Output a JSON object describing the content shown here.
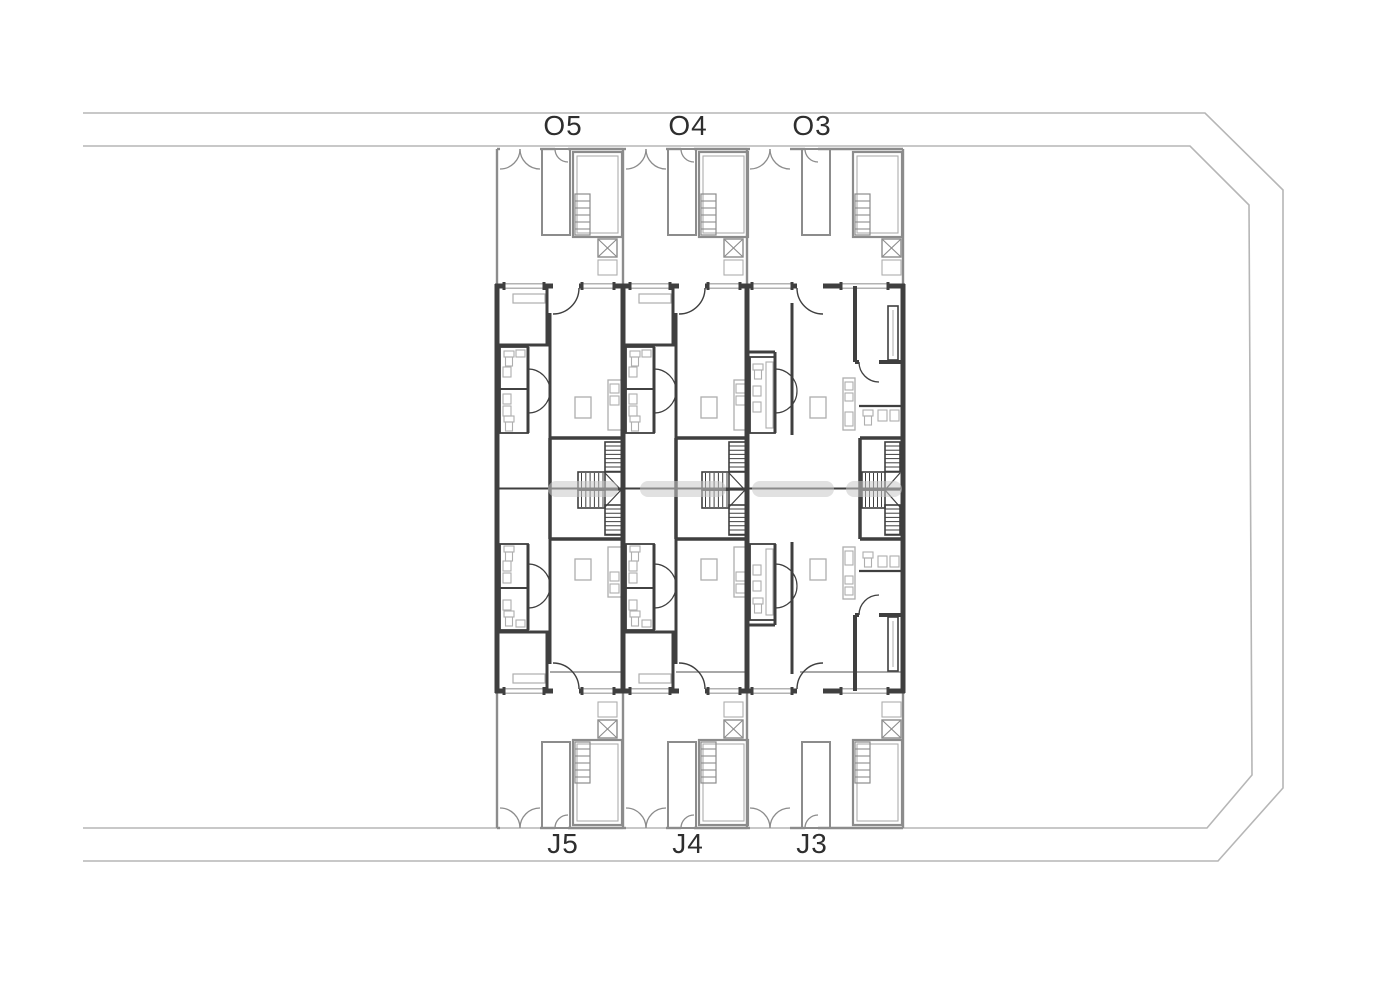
{
  "canvas": {
    "width": 1400,
    "height": 989,
    "background": "#ffffff"
  },
  "colors": {
    "site_line": "#b6b6b6",
    "yard_line": "#8c8c8c",
    "wall": "#3f3f3f",
    "fixture": "#aeaeae",
    "window": "#9a9a9a",
    "label": "#2e2e2e",
    "watermark": "#c8c8c8"
  },
  "site": {
    "outer_boundary": [
      [
        83,
        113
      ],
      [
        1205,
        113
      ],
      [
        1283,
        190
      ],
      [
        1283,
        788
      ],
      [
        1218,
        861
      ],
      [
        83,
        861
      ]
    ],
    "inner_boundary": [
      [
        83,
        146
      ],
      [
        1190,
        146
      ],
      [
        1249,
        205
      ],
      [
        1252,
        775
      ],
      [
        1207,
        828
      ],
      [
        83,
        828
      ]
    ]
  },
  "building": {
    "left": 497,
    "right": 903,
    "party_walls": [
      623,
      747
    ],
    "yard_top_wall": 149,
    "facade_top": 286,
    "facade_bottom": 691,
    "yard_bottom_wall": 828,
    "mirror_axis": 488.5
  },
  "units": [
    {
      "id": "unit-5",
      "top_label": "O5",
      "bottom_label": "J5",
      "x": 497,
      "width": 126,
      "layout": "A"
    },
    {
      "id": "unit-4",
      "top_label": "O4",
      "bottom_label": "J4",
      "x": 623,
      "width": 124,
      "layout": "A"
    },
    {
      "id": "unit-3",
      "top_label": "O3",
      "bottom_label": "J3",
      "x": 747,
      "width": 156,
      "layout": "B"
    }
  ],
  "labels": {
    "top": [
      {
        "text": "O5",
        "x": 563,
        "y": 112
      },
      {
        "text": "O4",
        "x": 688,
        "y": 112
      },
      {
        "text": "O3",
        "x": 812,
        "y": 112
      }
    ],
    "bottom": [
      {
        "text": "J5",
        "x": 563,
        "y": 830
      },
      {
        "text": "J4",
        "x": 688,
        "y": 830
      },
      {
        "text": "J3",
        "x": 812,
        "y": 830
      }
    ]
  },
  "watermark": {
    "y": 481,
    "height": 16,
    "segments": [
      [
        548,
        618
      ],
      [
        640,
        726
      ],
      [
        752,
        834
      ],
      [
        846,
        902
      ]
    ]
  }
}
